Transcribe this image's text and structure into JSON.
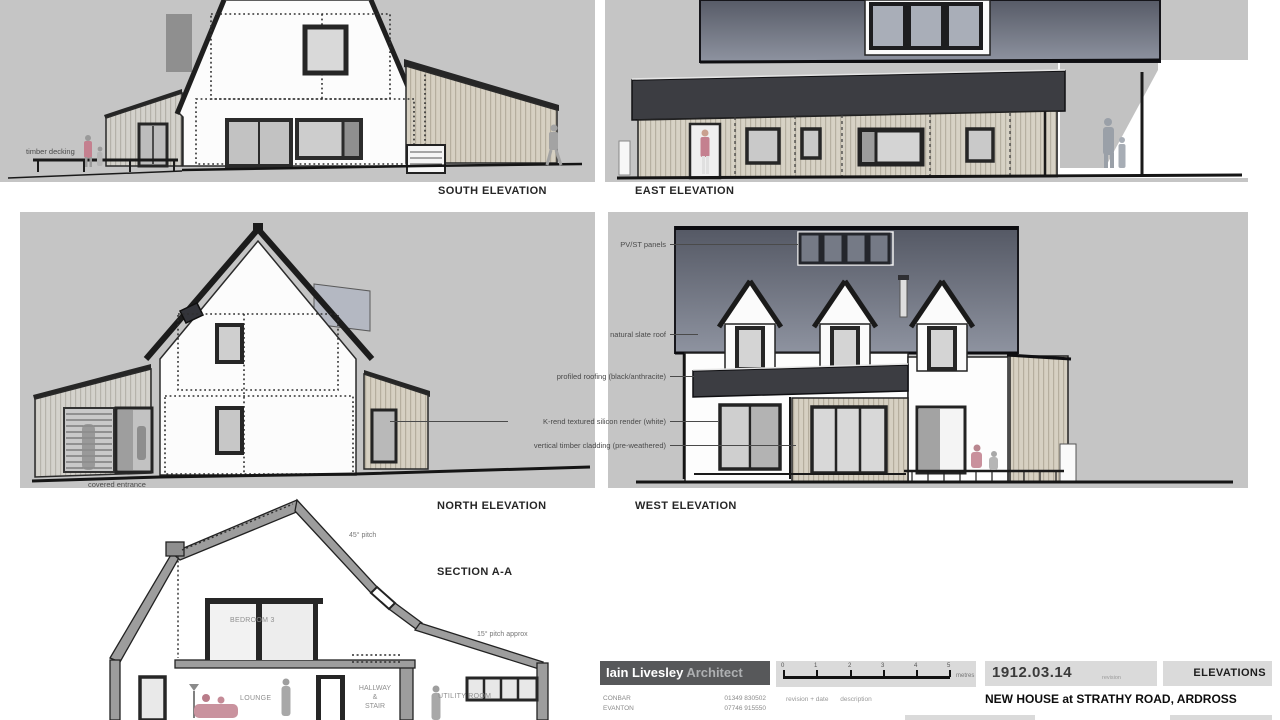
{
  "sheet": {
    "elevations": {
      "south_title": "SOUTH ELEVATION",
      "east_title": "EAST ELEVATION",
      "north_title": "NORTH ELEVATION",
      "west_title": "WEST ELEVATION",
      "section_title": "SECTION A-A"
    },
    "annotations": {
      "timber_decking": "timber decking",
      "covered_entrance": "covered entrance",
      "pv_st_panels": "PV/ST panels",
      "natural_slate_roof": "natural slate roof",
      "profiled_roofing": "profiled roofing (black/anthracite)",
      "k_rend": "K-rend textured silicon render (white)",
      "vertical_timber_cladding": "vertical timber cladding (pre-weathered)",
      "pitch_45": "45° pitch",
      "pitch_15": "15° pitch approx",
      "bedroom3": "BEDROOM 3",
      "lounge": "LOUNGE",
      "hallway_line1": "HALLWAY",
      "hallway_line2": "&",
      "hallway_line3": "STAIR",
      "utility_room": "UTILITY ROOM"
    },
    "title_block": {
      "firm_name": "Iain Livesley",
      "firm_suffix": "Architect",
      "address_line1": "CONBAR",
      "address_line2": "EVANTON",
      "phone1": "01349 830502",
      "phone2": "07746 915550",
      "scale_ticks": [
        "0",
        "1",
        "2",
        "3",
        "4",
        "5"
      ],
      "scale_unit": "metres",
      "revision_header_1": "revision + date",
      "revision_header_2": "description",
      "date": "1912.03.14",
      "revision_label": "revision",
      "sheet_name": "ELEVATIONS",
      "project_title": "NEW HOUSE at STRATHY ROAD, ARDROSS"
    },
    "colors": {
      "panel_bg": "#c5c5c5",
      "slate_dark": "#575b67",
      "slate_light": "#8e93a0",
      "anthracite": "#3c3d42",
      "cladding": "#d6d0c2",
      "cladding_stripe": "#b5ae9e",
      "ink": "#1d1d1d",
      "label_text": "#4a4a4a",
      "accent_pink": "#c4808f"
    }
  }
}
